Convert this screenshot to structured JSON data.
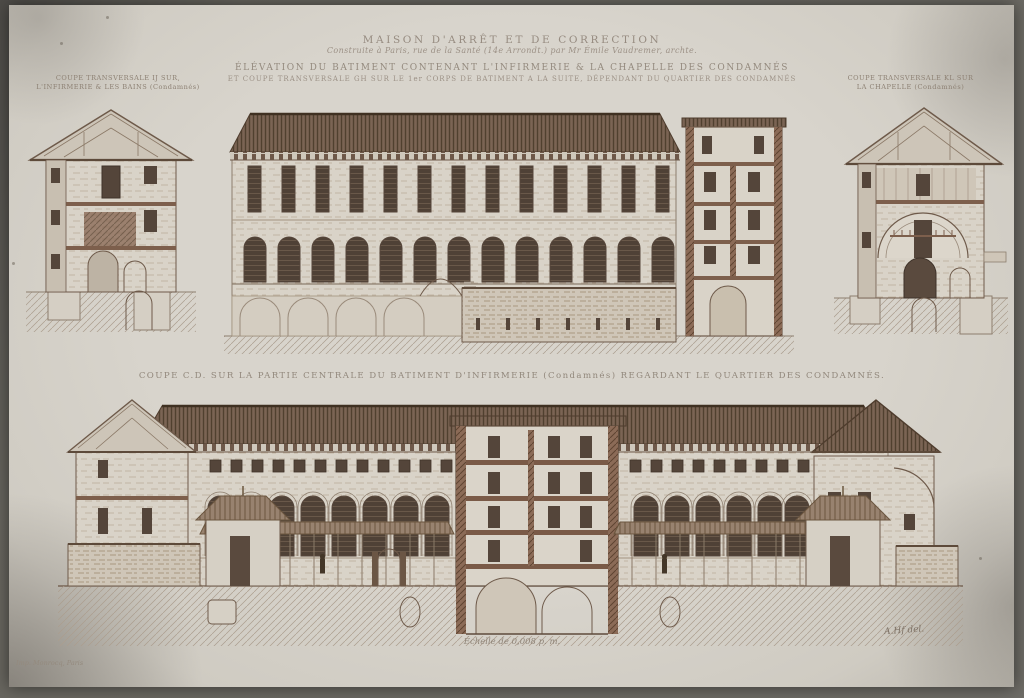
{
  "plate": {
    "title": "MAISON D'ARRÊT ET DE CORRECTION",
    "subtitle": "Construite à Paris, rue de la Santé (14e Arrondt.) par Mr Émile Vaudremer, archte.",
    "heading1": "ÉLÉVATION DU BATIMENT CONTENANT L'INFIRMERIE & LA CHAPELLE DES CONDAMNÉS",
    "heading2": "ET COUPE TRANSVERSALE GH SUR LE 1er CORPS DE BATIMENT A LA SUITE, DÉPENDANT DU QUARTIER DES CONDAMNÉS",
    "caption_left1": "COUPE TRANSVERSALE IJ SUR,",
    "caption_left2": "L'INFIRMERIE & LES BAINS (Condamnés)",
    "caption_right1": "COUPE TRANSVERSALE KL SUR",
    "caption_right2": "LA CHAPELLE (Condamnés)",
    "caption_middle": "COUPE C.D. SUR LA PARTIE CENTRALE DU BATIMENT D'INFIRMERIE (Condamnés) REGARDANT LE QUARTIER DES CONDAMNÉS.",
    "scale": "Échelle de 0,008 p. m.",
    "imprint": "Imp. Monrocq, Paris",
    "signature": "A.Hf del."
  },
  "colors": {
    "paper": "#d8d4cc",
    "ink": "#5e4b3c",
    "ink_faded": "#8d8174",
    "roof": "#6b5445",
    "wall_cut": "#8b6b57"
  }
}
